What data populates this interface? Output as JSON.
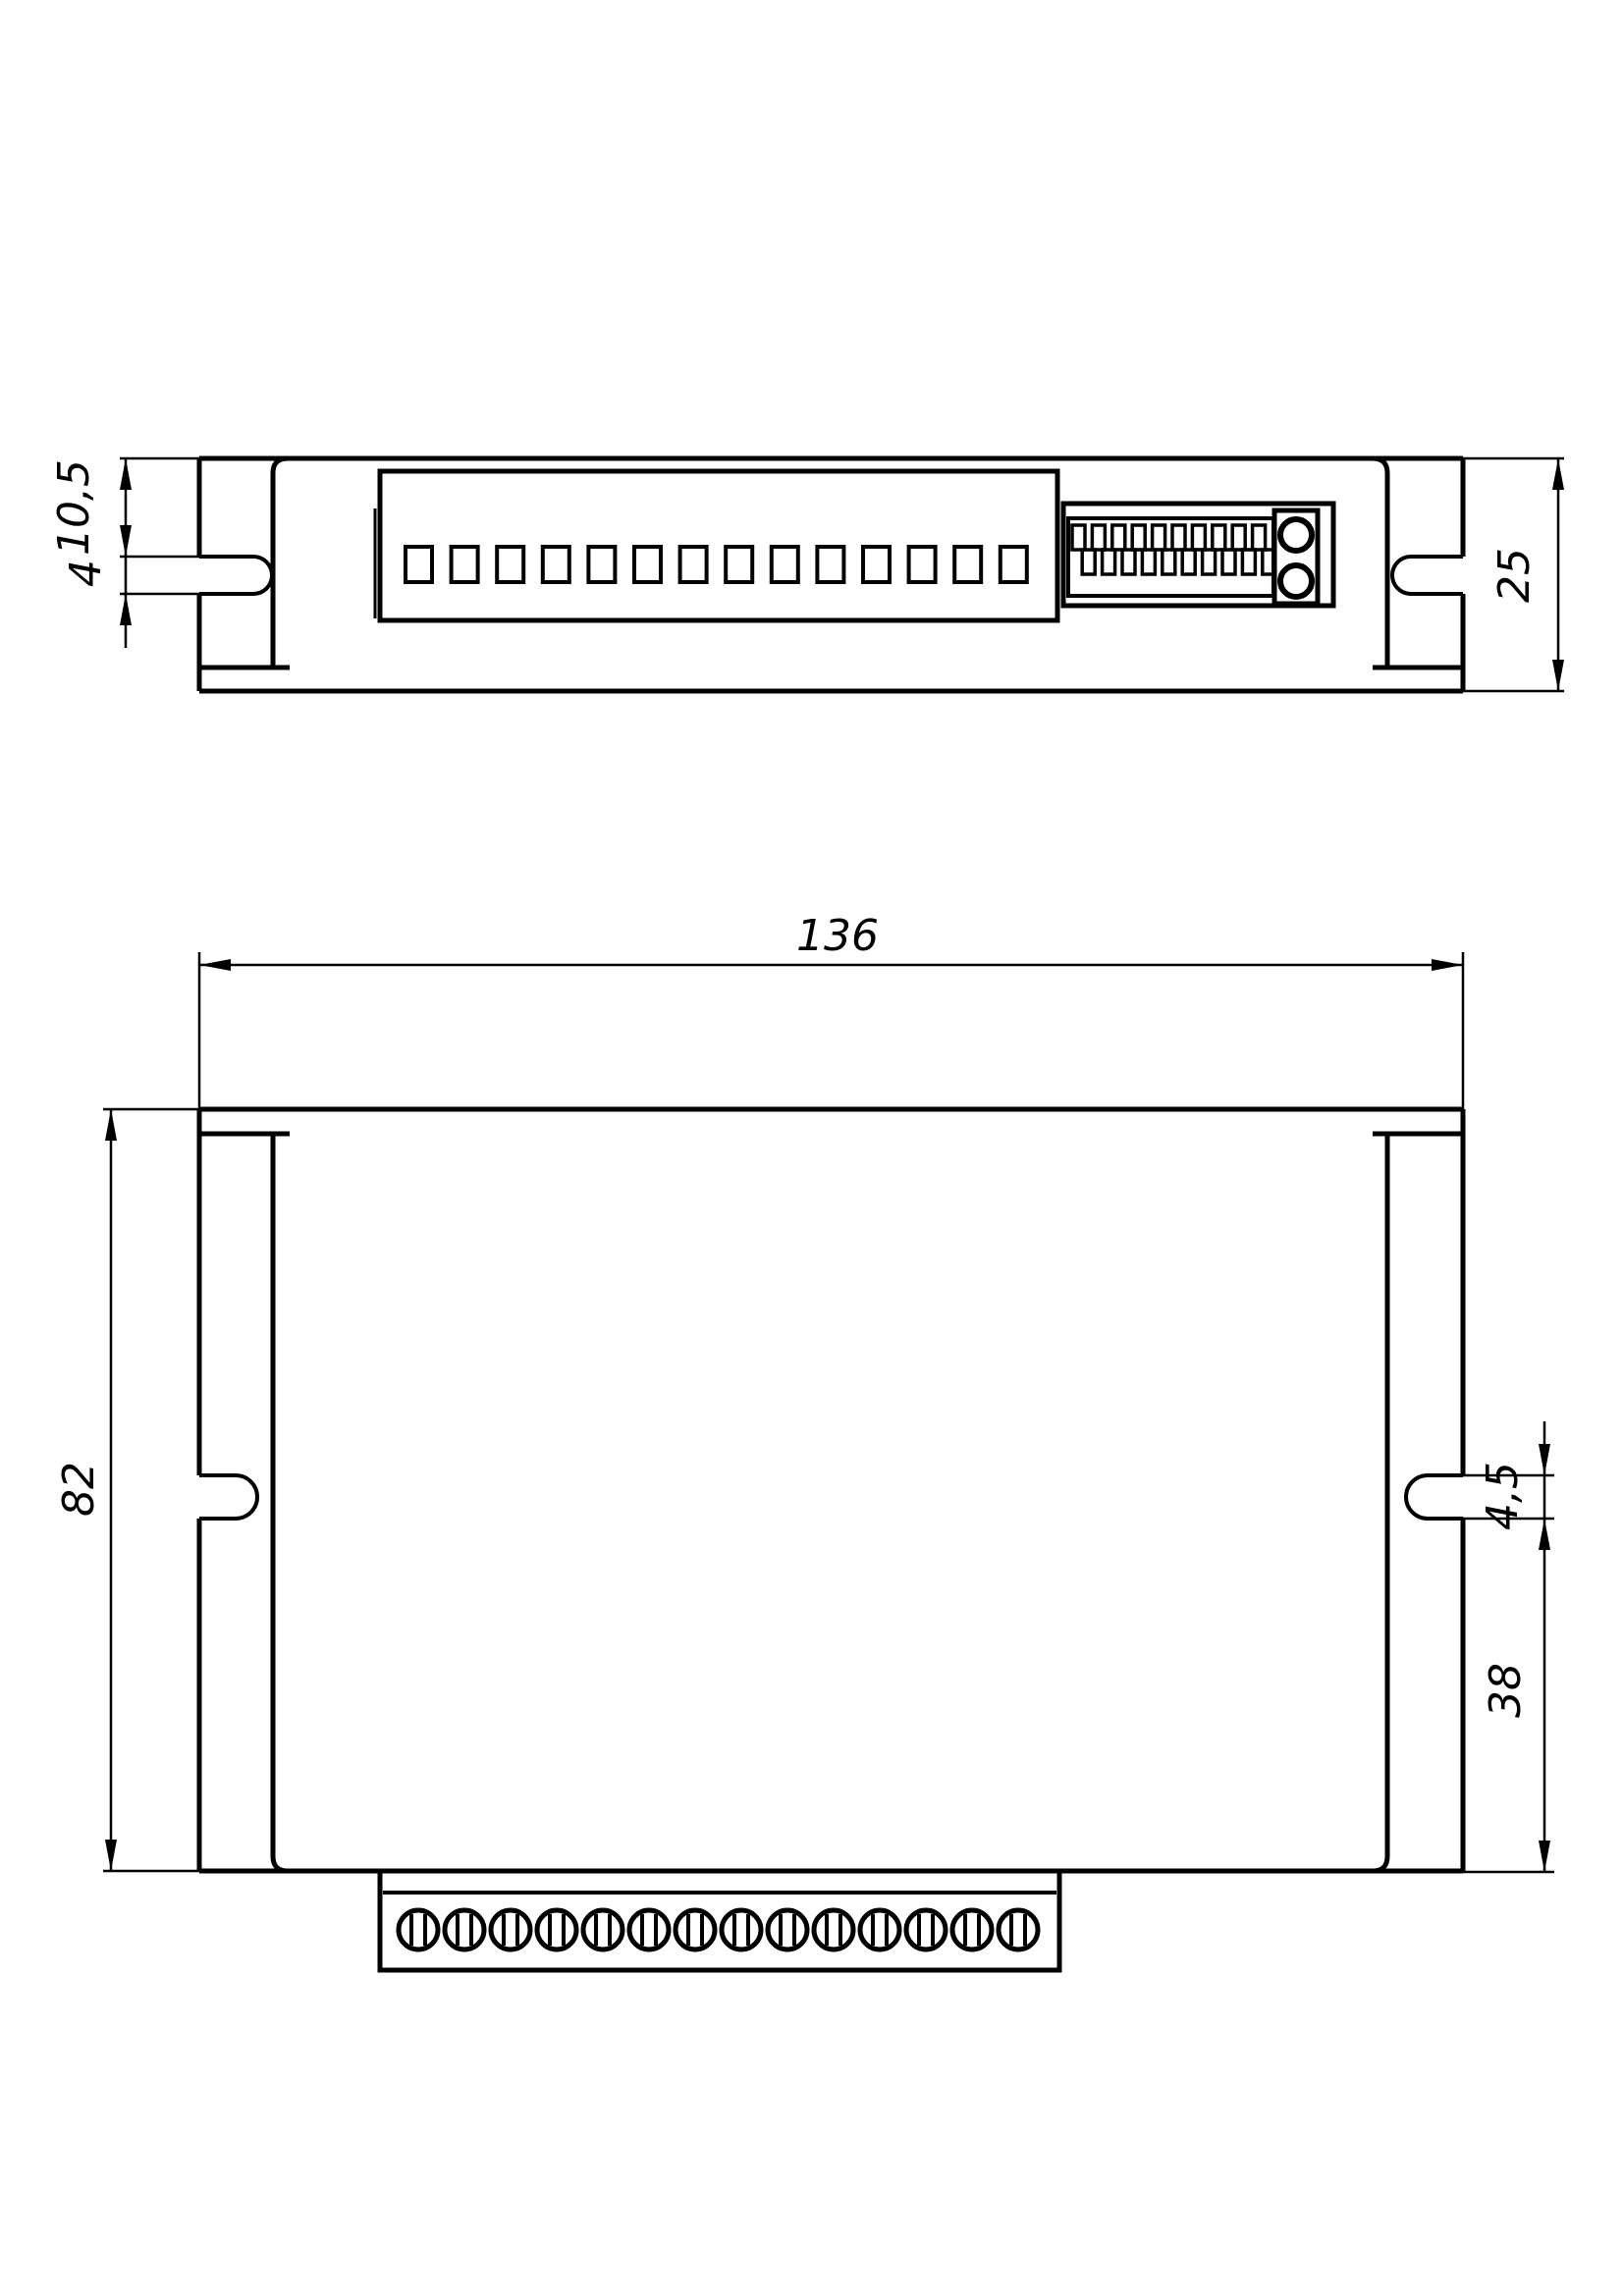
{
  "drawing": {
    "background_color": "#ffffff",
    "line_color": "#000000",
    "views": {
      "top": {
        "label": "top-view",
        "dimensions": {
          "edge_to_slot": "10,5",
          "slot_width": "4",
          "overall_depth": "25"
        },
        "connector": {
          "pin_count": 14
        },
        "dip_switch": {
          "tooth_count": 10,
          "screw_hole_count": 2
        }
      },
      "front": {
        "label": "front-view",
        "dimensions": {
          "overall_width": "136",
          "overall_height": "82",
          "slot_width": "4,5",
          "slot_to_bottom": "38"
        },
        "terminal_block": {
          "terminal_count": 14
        }
      }
    }
  }
}
